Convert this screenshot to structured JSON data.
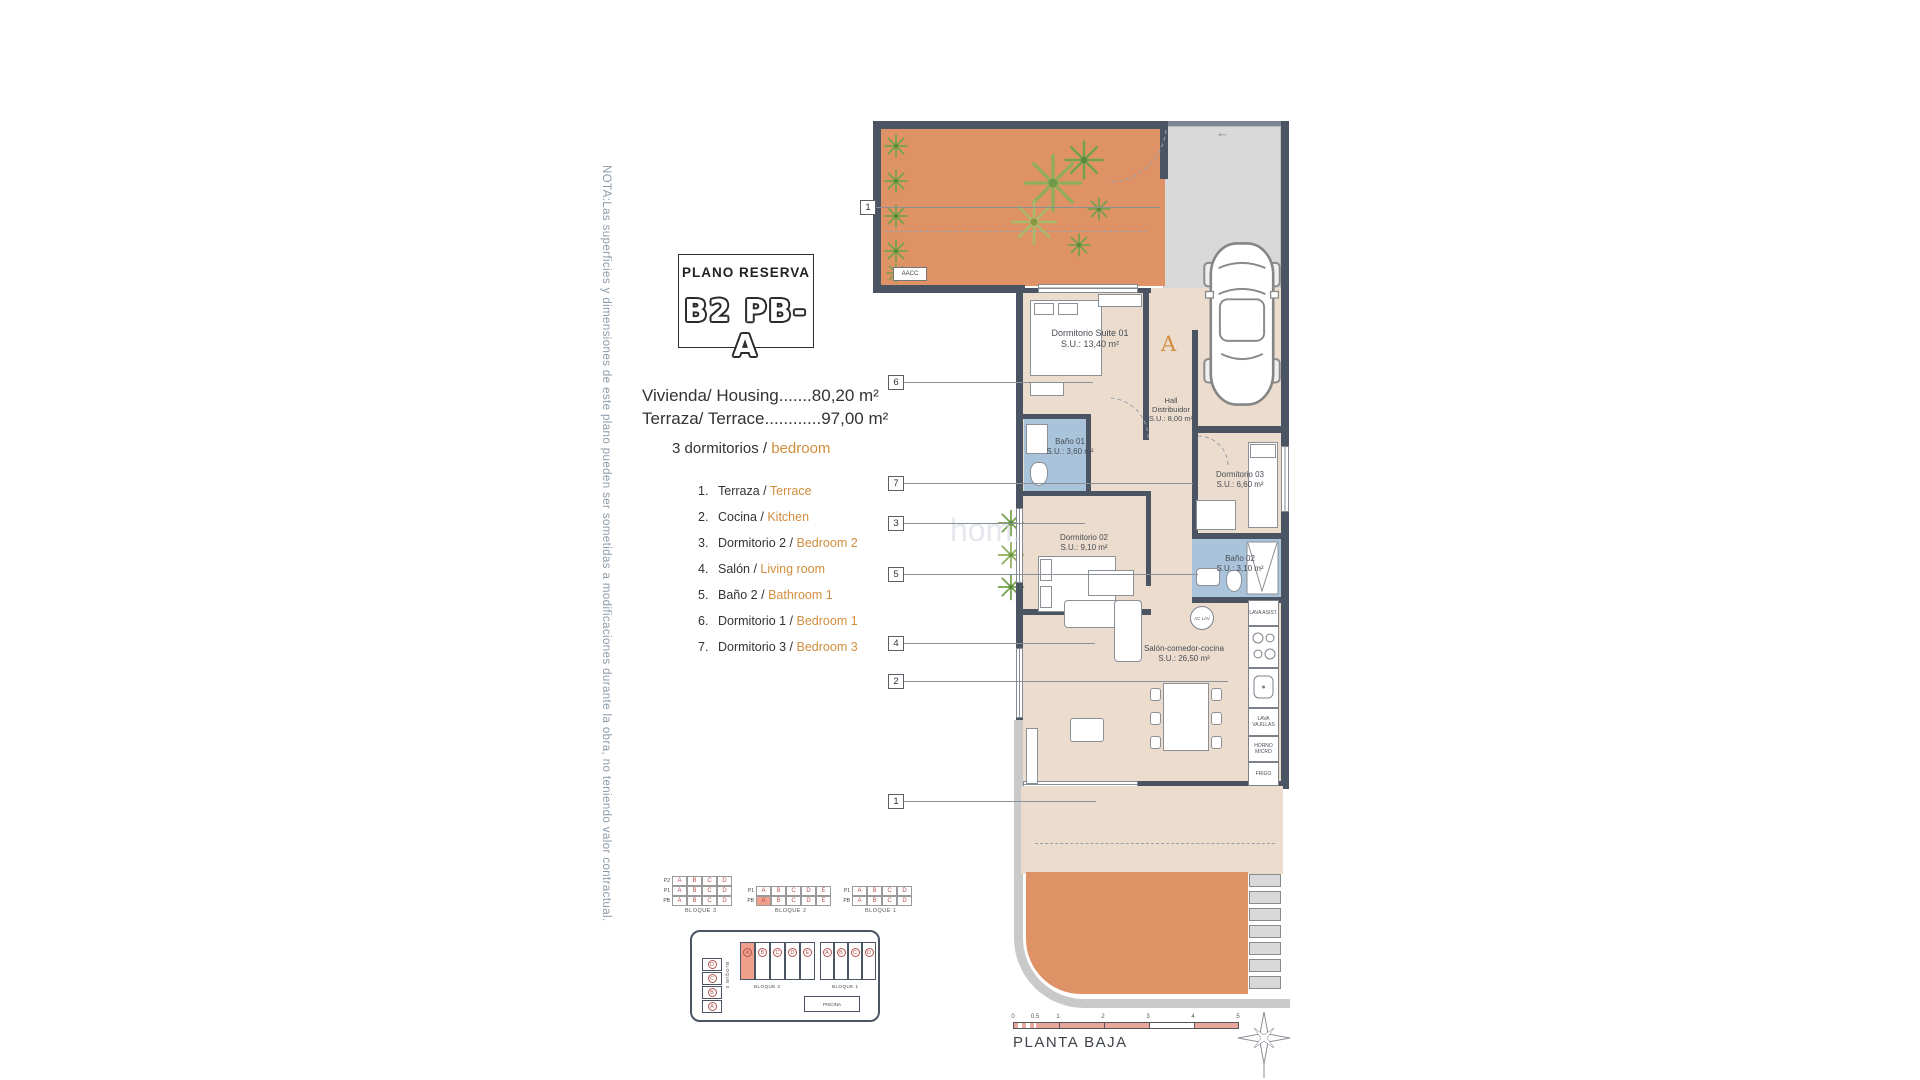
{
  "colors": {
    "walls": "#4A5462",
    "floor": "#EBDCCE",
    "bathroom": "#A9C3DA",
    "terrace_orange": "#DE9266",
    "driveway_gray": "#D9D9D9",
    "accent_orange": "#D28E3E",
    "note_blue": "#8C9BA8",
    "matrix_letter_red": "#B5534F",
    "highlight_salmon": "#F0A08A"
  },
  "note": "NOTA:Las superficies y dimensiones de este plano pueden ser sometidas a modificaciones durante la obra, no teniendo valor contractual.",
  "title": {
    "heading": "PLANO RESERVA",
    "code": "B2 PB-A"
  },
  "summary": {
    "housing": "Vivienda/ Housing.......80,20 m²",
    "terrace": "Terraza/ Terrace............97,00 m²",
    "bedrooms_es": "3 dormitorios /",
    "bedrooms_en": "bedroom"
  },
  "legend": [
    {
      "n": "1.",
      "es": "Terraza /",
      "en": "Terrace"
    },
    {
      "n": "2.",
      "es": "Cocina /",
      "en": "Kitchen"
    },
    {
      "n": "3.",
      "es": "Dormitorio 2 /",
      "en": "Bedroom 2"
    },
    {
      "n": "4.",
      "es": "Salón /",
      "en": "Living room"
    },
    {
      "n": "5.",
      "es": "Baño 2 /",
      "en": "Bathroom 1"
    },
    {
      "n": "6.",
      "es": "Dormitorio 1 /",
      "en": "Bedroom 1"
    },
    {
      "n": "7.",
      "es": "Dormitorio 3 /",
      "en": "Bedroom 3"
    }
  ],
  "plan": {
    "rooms": [
      {
        "name": "Dormitorio Suite 01",
        "area": "S.U.: 13,40 m²"
      },
      {
        "name": "Hall Distribuidor",
        "area": "S.U.: 8,00 m²"
      },
      {
        "name": "Baño 01",
        "area": "S.U.: 3,60 m²"
      },
      {
        "name": "Dormitorio 03",
        "area": "S.U.: 6,60 m²"
      },
      {
        "name": "Dormitorio 02",
        "area": "S.U.: 9,10 m²"
      },
      {
        "name": "Baño 02",
        "area": "S.U.: 3,10 m²"
      },
      {
        "name": "Salón-comedor-cocina",
        "area": "S.U.: 26,50 m²"
      }
    ],
    "kitchen_labels": [
      "LAVA ASIST.",
      "LAVA VAJILLAS",
      "HORNO MICRO",
      "FRIGO"
    ],
    "washer_label": "AC LAV",
    "aacc": "AACC",
    "entrance_letter": "A",
    "tags": [
      "1",
      "6",
      "7",
      "3",
      "5",
      "4",
      "2",
      "1"
    ],
    "watermark": "hom."
  },
  "key_matrix": {
    "b3": {
      "caption": "BLOQUE 3",
      "rows": [
        "P2",
        "P1",
        "PB"
      ],
      "letters": [
        "A",
        "B",
        "C",
        "D"
      ]
    },
    "b2": {
      "caption": "BLOQUE 2",
      "rows": [
        "P1",
        "PB"
      ],
      "letters": [
        "A",
        "B",
        "C",
        "D",
        "E"
      ]
    },
    "b1": {
      "caption": "BLOQUE 1",
      "rows": [
        "P1",
        "PB"
      ],
      "letters": [
        "A",
        "B",
        "C",
        "D"
      ]
    }
  },
  "site": {
    "b3_label": "BLOQUE 3",
    "b2_label": "BLOQUE 2",
    "b1_label": "BLOQUE 1",
    "b2_units": [
      "A",
      "B",
      "C",
      "D",
      "E"
    ],
    "b1_units": [
      "A",
      "B",
      "C",
      "D"
    ],
    "b3_units": [
      "D",
      "C",
      "B",
      "A"
    ],
    "pool": "PISCINA"
  },
  "scale": {
    "ticks": [
      "0",
      "0.5",
      "1",
      "2",
      "3",
      "4",
      "5"
    ],
    "floor_label": "PLANTA BAJA"
  }
}
